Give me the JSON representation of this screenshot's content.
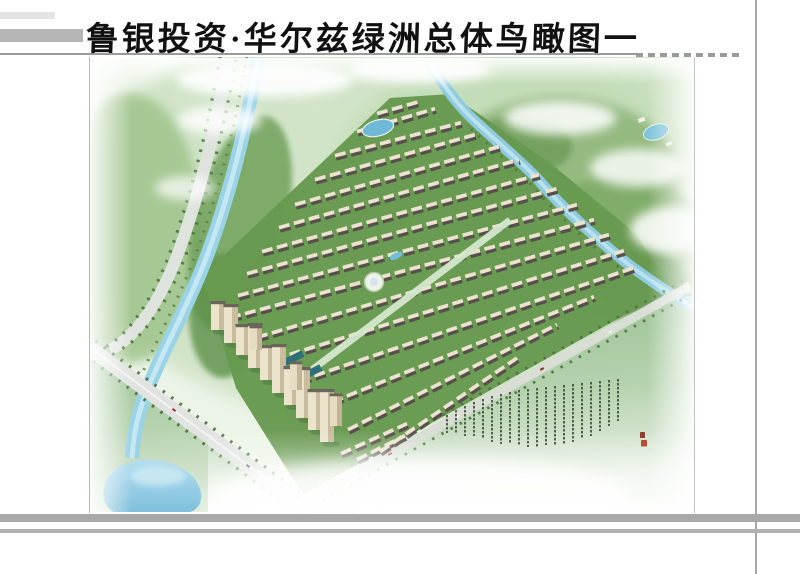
{
  "header": {
    "title": "鲁银投资·华尔兹绿洲总体鸟瞰图一"
  },
  "artwork": {
    "subject": "residential master plan bird's-eye rendering",
    "inscription": {
      "columns": 20,
      "seal_count": 2,
      "ink_color": "#2d3a2d",
      "seal_red": "#b5432a"
    },
    "palette": {
      "landscape_green": "#cfe3c5",
      "forest_green": "#6fa05a",
      "site_green": "#67994f",
      "lawn_green": "#8fba89",
      "river_blue": "#9ad2e6",
      "lake_blue": "#7fc0dc",
      "road_gray": "#dfe3de",
      "building_wall": "#ece3cb",
      "building_roof": "#56514a"
    }
  },
  "frame": {
    "accent_bar_gray": "#b6b6b6",
    "light_bar_gray": "#e4e4e4",
    "rule_gray": "#9a9a9a",
    "bottom_bar_gray": "#a9a9a9"
  }
}
